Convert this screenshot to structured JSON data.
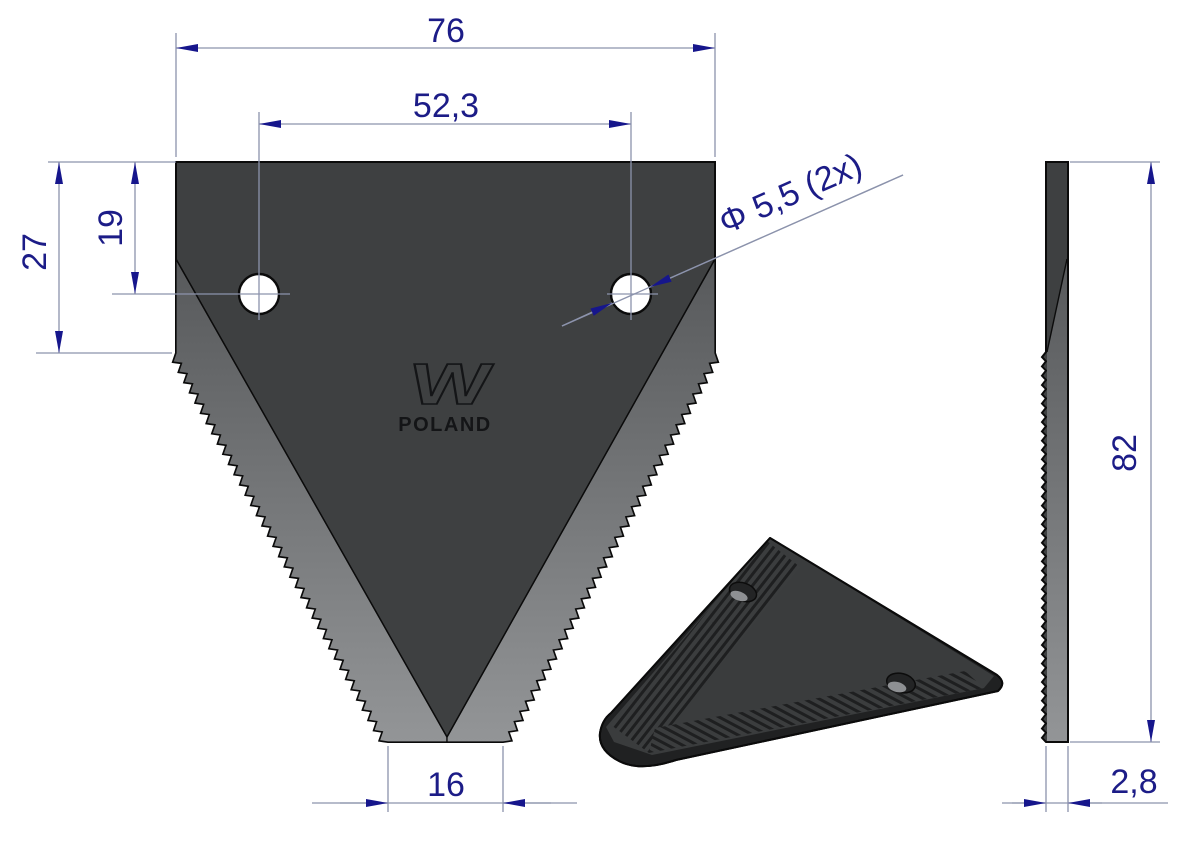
{
  "drawing": {
    "dimensions": {
      "overall_width": {
        "label": "76"
      },
      "hole_spacing": {
        "label": "52,3"
      },
      "edge_height": {
        "label": "27"
      },
      "hole_offset": {
        "label": "19"
      },
      "hole_diameter": {
        "label": "Φ 5,5  (2x)"
      },
      "tip_width": {
        "label": "16"
      },
      "blade_height": {
        "label": "82"
      },
      "thickness": {
        "label": "2,8"
      }
    },
    "logo": {
      "mark": "W",
      "country": "POLAND"
    }
  },
  "colors": {
    "background": "#ffffff",
    "blade": "#3e4041",
    "bevel_dark": "#57595b",
    "bevel_light": "#939597",
    "blade3d_face": "#3a3c3d",
    "blade3d_edge": "#202122",
    "outline": "#0b0b0b",
    "dimline": "#8c93ac",
    "dimtext": "#1c1c87",
    "arrow": "#16168c",
    "engrave": "#141517"
  }
}
